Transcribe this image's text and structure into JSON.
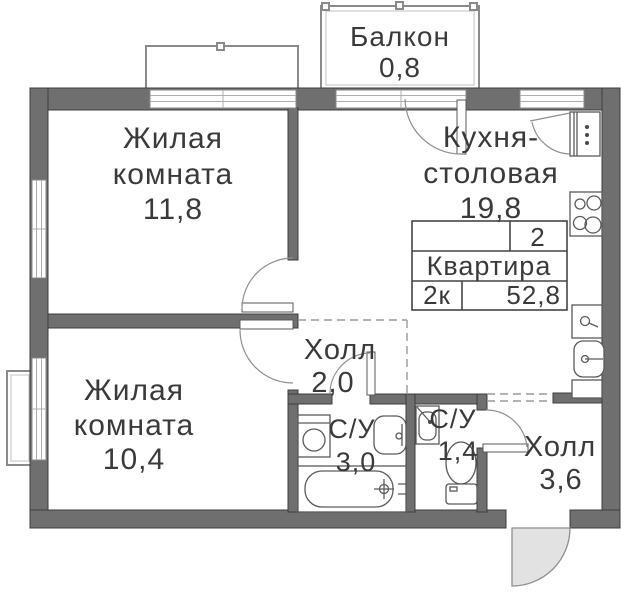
{
  "colors": {
    "wall": "#6f6f6f",
    "wall_stroke": "#3c3c3c",
    "line": "#8a8a8a",
    "text": "#3a3a3a",
    "door_fill": "#e2e2e2"
  },
  "legend": {
    "rooms_count": "2",
    "label": "Квартира",
    "plan_type": "2к",
    "total_area": "52,8"
  },
  "rooms": {
    "balcony": {
      "name": "Балкон",
      "area": "0,8"
    },
    "living1": {
      "line1": "Жилая",
      "line2": "комната",
      "area": "11,8"
    },
    "kitchen": {
      "line1": "Кухня-",
      "line2": "столовая",
      "area": "19,8"
    },
    "hall1": {
      "name": "Холл",
      "area": "2,0"
    },
    "living2": {
      "line1": "Жилая",
      "line2": "комната",
      "area": "10,4"
    },
    "bath1": {
      "name": "С/У",
      "area": "3,0"
    },
    "bath2": {
      "name": "С/У",
      "area": "1,4"
    },
    "hall2": {
      "name": "Холл",
      "area": "3,6"
    }
  }
}
